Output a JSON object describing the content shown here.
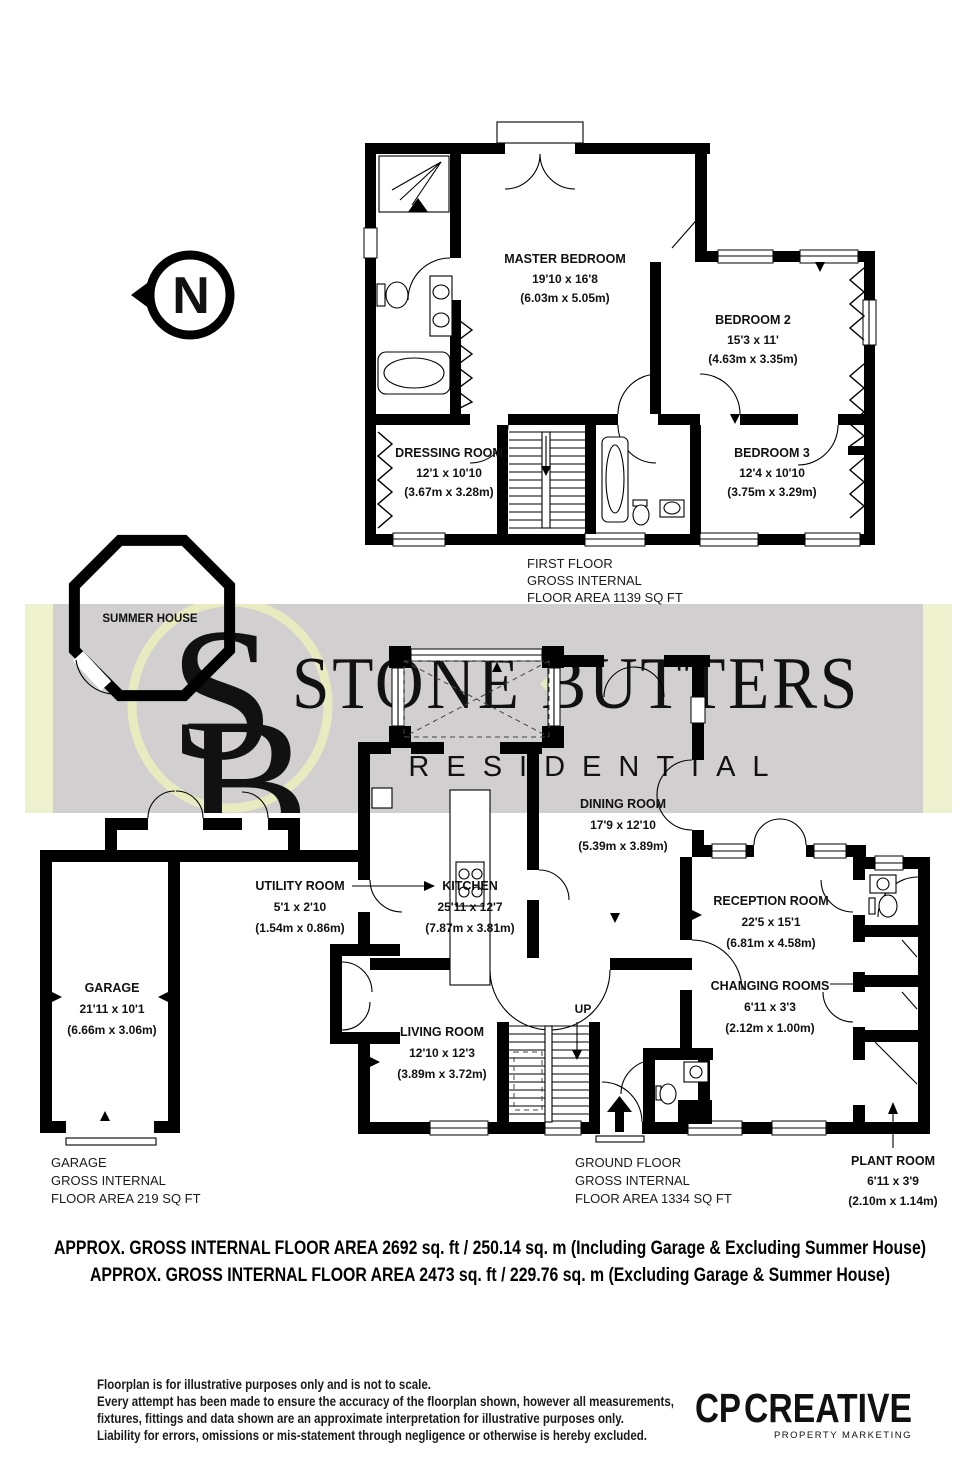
{
  "colors": {
    "band_gray": "#d1cfd0",
    "band_yellow": "#eef1cd",
    "monogram_yellow": "#e8ebbf",
    "brand_white": "#ffffff",
    "logo_navy": "#232157",
    "logo_gray": "#b5b8ba",
    "tagline_gray": "#a7abae",
    "north_gray": "#8a8a8a"
  },
  "compass": {
    "letter": "N"
  },
  "first_floor": {
    "caption": [
      "FIRST FLOOR",
      "GROSS INTERNAL",
      "FLOOR AREA 1139 SQ FT"
    ],
    "master_bedroom": {
      "name": "MASTER BEDROOM",
      "size_ft": "19'10 x 16'8",
      "size_m": "(6.03m x 5.05m)"
    },
    "bedroom_2": {
      "name": "BEDROOM 2",
      "size_ft": "15'3 x 11'",
      "size_m": "(4.63m x 3.35m)"
    },
    "bedroom_3": {
      "name": "BEDROOM 3",
      "size_ft": "12'4 x 10'10",
      "size_m": "(3.75m x 3.29m)"
    },
    "dressing_room": {
      "name": "DRESSING ROOM",
      "size_ft": "12'1 x 10'10",
      "size_m": "(3.67m x 3.28m)"
    }
  },
  "ground_floor": {
    "caption": [
      "GROUND FLOOR",
      "GROSS INTERNAL",
      "FLOOR AREA 1334 SQ FT"
    ],
    "up_label": "UP",
    "dining_room": {
      "name": "DINING ROOM",
      "size_ft": "17'9 x 12'10",
      "size_m": "(5.39m x 3.89m)"
    },
    "kitchen": {
      "name": "KITCHEN",
      "size_ft": "25'11 x 12'7",
      "size_m": "(7.87m x 3.81m)"
    },
    "utility_room": {
      "name": "UTILITY ROOM",
      "size_ft": "5'1 x 2'10",
      "size_m": "(1.54m x 0.86m)"
    },
    "living_room": {
      "name": "LIVING ROOM",
      "size_ft": "12'10 x 12'3",
      "size_m": "(3.89m x 3.72m)"
    },
    "reception_room": {
      "name": "RECEPTION ROOM",
      "size_ft": "22'5 x 15'1",
      "size_m": "(6.81m x 4.58m)"
    },
    "changing_rooms": {
      "name": "CHANGING ROOMS",
      "size_ft": "6'11 x 3'3",
      "size_m": "(2.12m x 1.00m)"
    },
    "plant_room": {
      "name": "PLANT ROOM",
      "size_ft": "6'11 x 3'9",
      "size_m": "(2.10m x 1.14m)"
    }
  },
  "garage": {
    "room": {
      "name": "GARAGE",
      "size_ft": "21'11 x 10'1",
      "size_m": "(6.66m x 3.06m)"
    },
    "caption": [
      "GARAGE",
      "GROSS INTERNAL",
      "FLOOR AREA 219 SQ FT"
    ]
  },
  "summer_house": {
    "label": "SUMMER HOUSE"
  },
  "watermark": {
    "brand": "STONE BUTTERS",
    "sub": "RESIDENTIAL",
    "monogram_s": "S",
    "monogram_b": "B"
  },
  "totals": [
    "APPROX. GROSS INTERNAL FLOOR AREA 2692 sq. ft / 250.14 sq. m (Including Garage & Excluding Summer House)",
    "APPROX. GROSS INTERNAL FLOOR AREA 2473 sq. ft / 229.76 sq. m (Excluding Garage & Summer House)"
  ],
  "disclaimer": [
    "Floorplan is for illustrative purposes only and is not to scale.",
    "Every attempt has been made to ensure the accuracy of the floorplan shown, however all measurements,",
    "fixtures, fittings and data shown are an approximate interpretation for illustrative purposes only.",
    "Liability for errors, omissions or mis-statement through negligence or otherwise is hereby excluded."
  ],
  "footer_logo": {
    "cp": "CP",
    "creative": "CREATIVE",
    "tagline": "PROPERTY MARKETING"
  }
}
